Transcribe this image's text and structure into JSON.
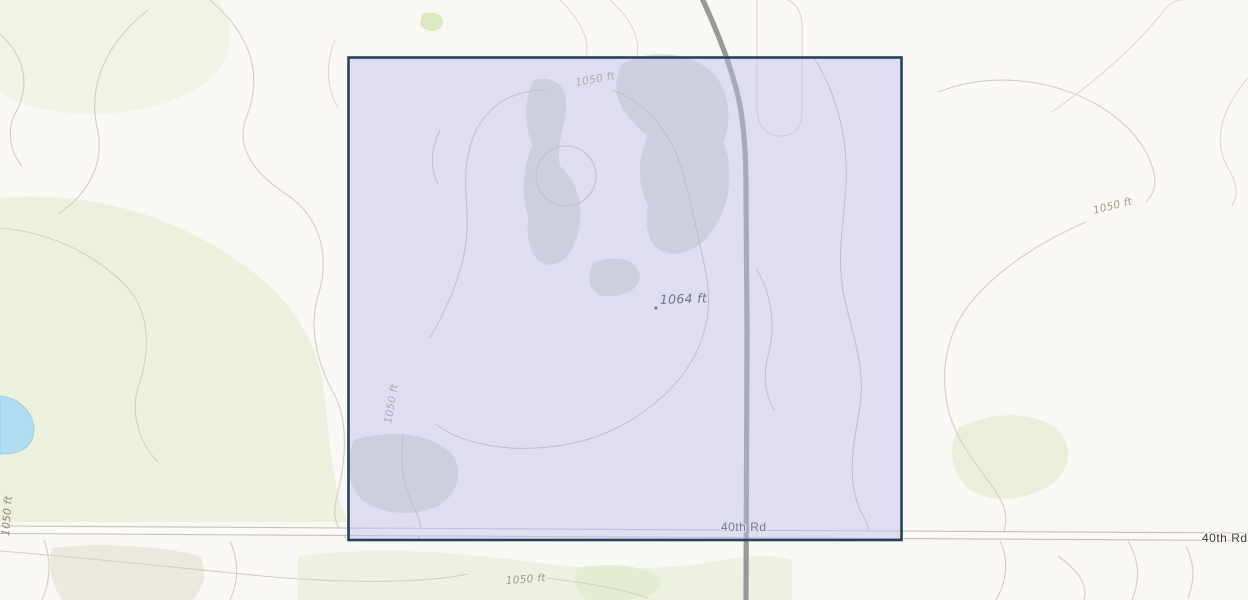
{
  "map": {
    "labels": {
      "contour_1050": "1050 ft",
      "spot_elevation": "1064 ft",
      "road_40th": "40th Rd"
    },
    "colors": {
      "background": "#f9f8f4",
      "vegetation": "#ecf1de",
      "vegetation_bright": "#dce9c0",
      "terrain_shade": "#dbddd6",
      "water": "#b0ddf1",
      "road_major": "#989898",
      "road_minor_casing": "#c8c2b4",
      "contour_line": "#d5cec0",
      "selection_fill": "#bdbfec",
      "selection_border": "#26435e",
      "road_label_text": "#3c3c3c",
      "contour_label_text": "#a29a89"
    },
    "selection": {
      "shape": "rectangle",
      "description": "square section selection overlay"
    }
  }
}
